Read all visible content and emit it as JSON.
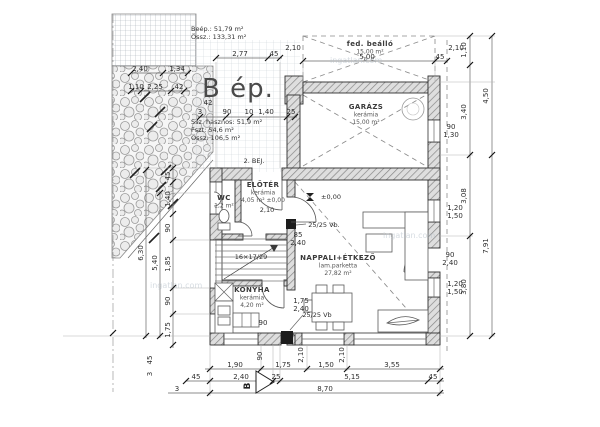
{
  "title": "B ép.",
  "colors": {
    "line": "#2f2f2f",
    "wall_hatch": "#878787",
    "grid": "#cdd2d8",
    "watermark": "#b4bfc9"
  },
  "watermark_text": "ingatlan.com",
  "rooms": [
    {
      "name": "garazs",
      "lines": [
        "GARÁZS",
        "kerámia",
        "15,00 m²"
      ],
      "x": 366,
      "y": 109
    },
    {
      "name": "fedett-beallo",
      "lines": [
        "fed. beálló",
        "15,00 m²"
      ],
      "x": 370,
      "y": 46
    },
    {
      "name": "eloter",
      "lines": [
        "ELŐTÉR",
        "kerámia",
        "4,05 m² ±0,00"
      ],
      "x": 263,
      "y": 187
    },
    {
      "name": "wc",
      "lines": [
        "WC",
        "1,2 m²"
      ],
      "x": 224,
      "y": 200
    },
    {
      "name": "konyha",
      "lines": [
        "KONYHA",
        "kerámia",
        "4,20 m²"
      ],
      "x": 252,
      "y": 292
    },
    {
      "name": "nappali-etkezo",
      "lines": [
        "NAPPALI+ÉTKEZŐ",
        "lam.parketta",
        "27,82 m²"
      ],
      "x": 338,
      "y": 260
    }
  ],
  "texts": [
    {
      "t": "Beép.: 51,79 m²",
      "x": 191,
      "y": 31,
      "c": "stats"
    },
    {
      "t": "Össz.: 133,31 m²",
      "x": 191,
      "y": 39,
      "c": "stats"
    },
    {
      "t": "Ssz. hasznos: 51,9 m²",
      "x": 191,
      "y": 124,
      "c": "stats"
    },
    {
      "t": "Fszt: 54,6 m²",
      "x": 191,
      "y": 132,
      "c": "stats"
    },
    {
      "t": "Össz: 106,5 m²",
      "x": 191,
      "y": 140,
      "c": "stats"
    },
    {
      "t": "2. BEJ.",
      "x": 254,
      "y": 163,
      "c": "lbl"
    },
    {
      "t": "±0,00",
      "x": 331,
      "y": 199,
      "c": "lbl"
    },
    {
      "t": "25/25 Vb.",
      "x": 324,
      "y": 227,
      "c": "lbl"
    },
    {
      "t": "25/25 Vb",
      "x": 317,
      "y": 317,
      "c": "lbl"
    },
    {
      "t": "16×17/29",
      "x": 251,
      "y": 259,
      "c": "lbl",
      "s": 6
    },
    {
      "t": "2,10",
      "x": 267,
      "y": 212,
      "c": "lbl"
    },
    {
      "t": "85",
      "x": 298,
      "y": 237,
      "s": 6
    },
    {
      "t": "2,40",
      "x": 298,
      "y": 245,
      "s": 6
    },
    {
      "t": "1,75",
      "x": 301,
      "y": 303,
      "s": 6
    },
    {
      "t": "2,40",
      "x": 301,
      "y": 311,
      "s": 6
    },
    {
      "t": "90",
      "x": 263,
      "y": 325,
      "s": 6
    },
    {
      "t": "2,40",
      "x": 140,
      "y": 71
    },
    {
      "t": "1,34",
      "x": 177,
      "y": 71
    },
    {
      "t": "1,10",
      "x": 136,
      "y": 89
    },
    {
      "t": "2,25",
      "x": 155,
      "y": 89
    },
    {
      "t": "42",
      "x": 179,
      "y": 89
    },
    {
      "t": "2,77",
      "x": 240,
      "y": 56
    },
    {
      "t": "45",
      "x": 274,
      "y": 56
    },
    {
      "t": "5,00",
      "x": 367,
      "y": 59
    },
    {
      "t": "45",
      "x": 440,
      "y": 59
    },
    {
      "t": "2,10",
      "x": 293,
      "y": 50
    },
    {
      "t": "2,10",
      "x": 456,
      "y": 50
    },
    {
      "t": "42",
      "x": 208,
      "y": 105
    },
    {
      "t": "3",
      "x": 200,
      "y": 114
    },
    {
      "t": "90",
      "x": 227,
      "y": 114
    },
    {
      "t": "10",
      "x": 249,
      "y": 114
    },
    {
      "t": "1,40",
      "x": 266,
      "y": 114
    },
    {
      "t": "25",
      "x": 291,
      "y": 114
    },
    {
      "t": "1,10",
      "x": 466,
      "y": 50,
      "r": -90
    },
    {
      "t": "3,40",
      "x": 466,
      "y": 112,
      "r": -90
    },
    {
      "t": "3,08",
      "x": 466,
      "y": 196,
      "r": -90
    },
    {
      "t": "3,80",
      "x": 466,
      "y": 287,
      "r": -90
    },
    {
      "t": "4,50",
      "x": 488,
      "y": 96,
      "r": -90
    },
    {
      "t": "7,91",
      "x": 488,
      "y": 246,
      "r": -90
    },
    {
      "t": "90",
      "x": 451,
      "y": 129,
      "s": 6
    },
    {
      "t": "1,30",
      "x": 451,
      "y": 137,
      "s": 6
    },
    {
      "t": "1,20",
      "x": 455,
      "y": 210,
      "s": 6
    },
    {
      "t": "1,50",
      "x": 455,
      "y": 218,
      "s": 6
    },
    {
      "t": "90",
      "x": 450,
      "y": 257,
      "s": 6
    },
    {
      "t": "2,40",
      "x": 450,
      "y": 265,
      "s": 6
    },
    {
      "t": "1,20",
      "x": 455,
      "y": 286,
      "s": 6
    },
    {
      "t": "1,50",
      "x": 455,
      "y": 294,
      "s": 6
    },
    {
      "t": "6,30",
      "x": 143,
      "y": 253,
      "r": -90
    },
    {
      "t": "5,40",
      "x": 157,
      "y": 263,
      "r": -90
    },
    {
      "t": "45",
      "x": 170,
      "y": 176,
      "r": -90
    },
    {
      "t": "1,40",
      "x": 170,
      "y": 199,
      "r": -90
    },
    {
      "t": "90",
      "x": 170,
      "y": 228,
      "r": -90
    },
    {
      "t": "1,85",
      "x": 170,
      "y": 264,
      "r": -90
    },
    {
      "t": "90",
      "x": 170,
      "y": 301,
      "r": -90
    },
    {
      "t": "1,75",
      "x": 170,
      "y": 330,
      "r": -90
    },
    {
      "t": "45",
      "x": 152,
      "y": 360,
      "r": -90
    },
    {
      "t": "3",
      "x": 152,
      "y": 374,
      "r": -90
    },
    {
      "t": "1,90",
      "x": 235,
      "y": 367
    },
    {
      "t": "1,75",
      "x": 283,
      "y": 367
    },
    {
      "t": "1,50",
      "x": 326,
      "y": 367
    },
    {
      "t": "3,55",
      "x": 392,
      "y": 367
    },
    {
      "t": "45",
      "x": 196,
      "y": 379
    },
    {
      "t": "2,40",
      "x": 241,
      "y": 379
    },
    {
      "t": "25",
      "x": 276,
      "y": 379
    },
    {
      "t": "5,15",
      "x": 352,
      "y": 379
    },
    {
      "t": "45",
      "x": 433,
      "y": 379
    },
    {
      "t": "3",
      "x": 177,
      "y": 391
    },
    {
      "t": "8,70",
      "x": 325,
      "y": 391
    },
    {
      "t": "90",
      "x": 262,
      "y": 356,
      "r": -90,
      "s": 6
    },
    {
      "t": "2,10",
      "x": 303,
      "y": 355,
      "r": -90,
      "s": 6
    },
    {
      "t": "2,10",
      "x": 344,
      "y": 355,
      "r": -90,
      "s": 6
    },
    {
      "t": "B",
      "x": 250,
      "y": 386,
      "r": -90,
      "c": "section"
    },
    {
      "t": "ingatlan.com",
      "x": 150,
      "y": 288,
      "c": "wm"
    },
    {
      "t": "ingatlan.com",
      "x": 383,
      "y": 238,
      "c": "wm"
    },
    {
      "t": "ingatlan.com",
      "x": 330,
      "y": 63,
      "c": "wm"
    }
  ],
  "ticks": [
    {
      "x": 210,
      "y": 369
    },
    {
      "x": 261,
      "y": 369
    },
    {
      "x": 307,
      "y": 369
    },
    {
      "x": 347,
      "y": 369
    },
    {
      "x": 440,
      "y": 369
    },
    {
      "x": 186,
      "y": 381
    },
    {
      "x": 210,
      "y": 381
    },
    {
      "x": 273,
      "y": 381
    },
    {
      "x": 280,
      "y": 381
    },
    {
      "x": 428,
      "y": 381
    },
    {
      "x": 440,
      "y": 381
    },
    {
      "x": 210,
      "y": 393
    },
    {
      "x": 440,
      "y": 393
    },
    {
      "x": 303,
      "y": 61
    },
    {
      "x": 435,
      "y": 61
    },
    {
      "x": 447,
      "y": 61
    },
    {
      "x": 216,
      "y": 58
    },
    {
      "x": 268,
      "y": 58
    },
    {
      "x": 280,
      "y": 58
    },
    {
      "x": 200,
      "y": 117
    },
    {
      "x": 226,
      "y": 117
    },
    {
      "x": 250,
      "y": 117
    },
    {
      "x": 287,
      "y": 117
    },
    {
      "x": 295,
      "y": 117
    },
    {
      "x": 131,
      "y": 73
    },
    {
      "x": 163,
      "y": 73
    },
    {
      "x": 188,
      "y": 73
    },
    {
      "x": 131,
      "y": 91
    },
    {
      "x": 141,
      "y": 91
    },
    {
      "x": 171,
      "y": 91
    },
    {
      "x": 184,
      "y": 91
    },
    {
      "x": 470,
      "y": 36
    },
    {
      "x": 470,
      "y": 65
    },
    {
      "x": 470,
      "y": 155
    },
    {
      "x": 470,
      "y": 236
    },
    {
      "x": 470,
      "y": 336
    },
    {
      "x": 492,
      "y": 36
    },
    {
      "x": 492,
      "y": 155
    },
    {
      "x": 492,
      "y": 336
    },
    {
      "x": 146,
      "y": 170
    },
    {
      "x": 146,
      "y": 336
    },
    {
      "x": 160,
      "y": 193
    },
    {
      "x": 160,
      "y": 336
    },
    {
      "x": 173,
      "y": 168
    },
    {
      "x": 173,
      "y": 182
    },
    {
      "x": 173,
      "y": 214
    },
    {
      "x": 173,
      "y": 240
    },
    {
      "x": 173,
      "y": 288
    },
    {
      "x": 173,
      "y": 314
    },
    {
      "x": 173,
      "y": 345
    },
    {
      "x": 113,
      "y": 333
    }
  ]
}
